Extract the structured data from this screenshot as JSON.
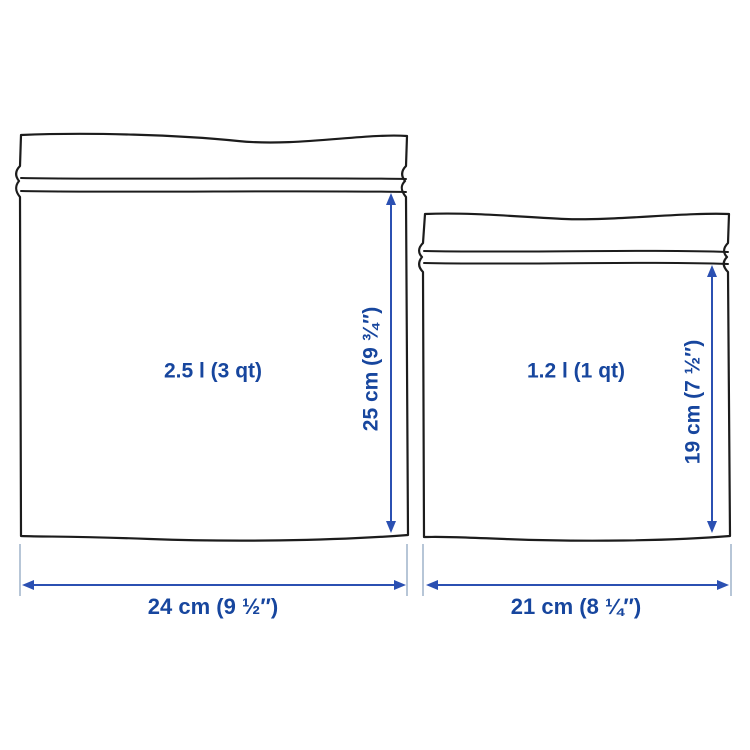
{
  "diagram": {
    "description": "Dimension drawing of two resealable plastic bags",
    "colors": {
      "label_blue": "#17469e",
      "arrow_blue": "#2b50b2",
      "extension_line": "#a5b7cd",
      "bag_outline": "#1c1c1c",
      "background": "#ffffff"
    },
    "bags": [
      {
        "name": "large-bag",
        "volume_label": "2.5 l (3 qt)",
        "height_label": "25 cm (9 ¾″)",
        "width_label": "24 cm (9 ½″)"
      },
      {
        "name": "small-bag",
        "volume_label": "1.2 l (1 qt)",
        "height_label": "19 cm (7 ½″)",
        "width_label": "21 cm (8 ¼″)"
      }
    ]
  }
}
